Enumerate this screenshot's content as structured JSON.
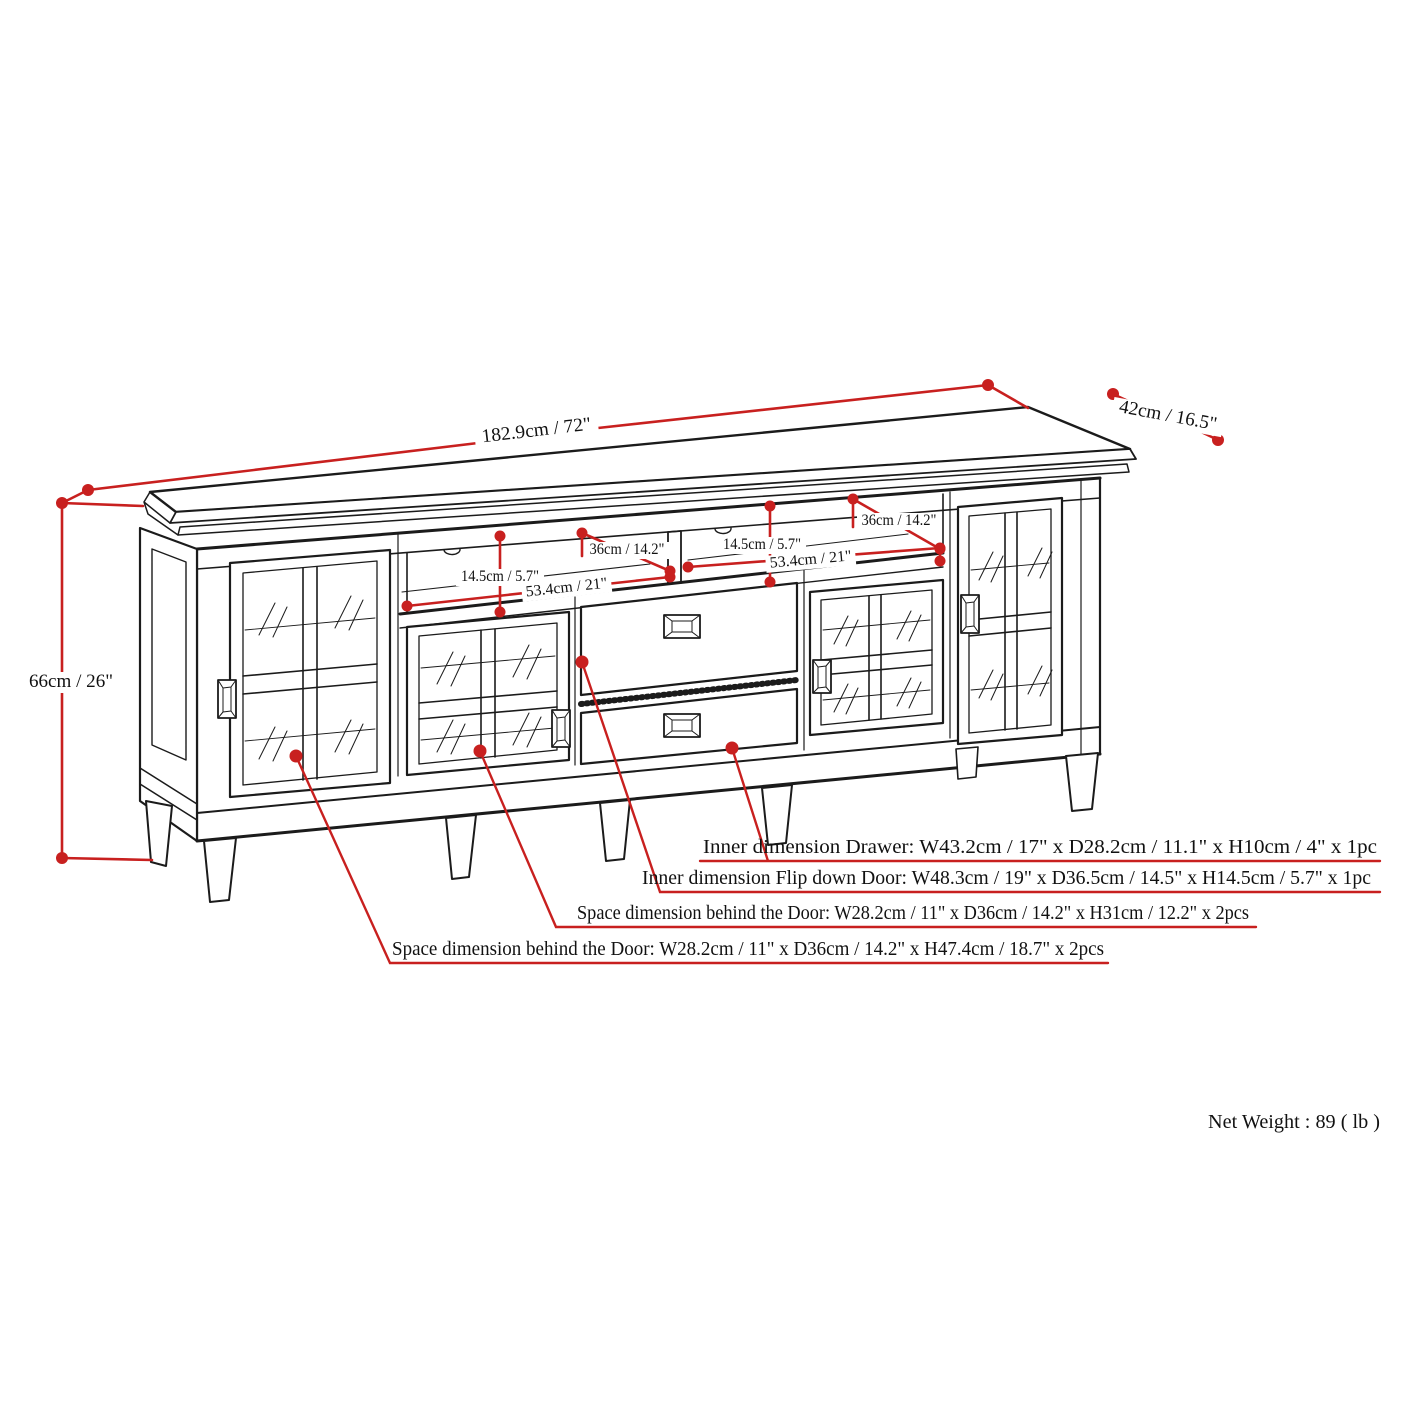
{
  "colors": {
    "dimension_red": "#c8201f",
    "line_black": "#1b1b1b",
    "background": "#ffffff"
  },
  "overall_dimensions": {
    "width": "182.9cm / 72\"",
    "depth": "42cm / 16.5\"",
    "height": "66cm / 26\""
  },
  "shelf_compartments": {
    "left": {
      "height": "14.5cm / 5.7\"",
      "width": "53.4cm / 21\"",
      "depth": "36cm / 14.2\""
    },
    "right": {
      "height": "14.5cm / 5.7\"",
      "width": "53.4cm / 21\"",
      "depth": "36cm / 14.2\""
    }
  },
  "callouts": {
    "drawer": "Inner dimension Drawer: W43.2cm / 17\" x D28.2cm / 11.1\" x H10cm / 4\" x 1pc",
    "flip_down_door": "Inner dimension Flip down Door: W48.3cm / 19\" x D36.5cm / 14.5\" x H14.5cm / 5.7\" x 1pc",
    "behind_door_short": "Space dimension behind the Door: W28.2cm / 11\" x D36cm / 14.2\" x H31cm / 12.2\" x 2pcs",
    "behind_door_tall": "Space dimension behind the Door:  W28.2cm / 11\" x D36cm / 14.2\" x H47.4cm / 18.7\" x 2pcs"
  },
  "net_weight": "Net Weight : 89 ( lb )"
}
